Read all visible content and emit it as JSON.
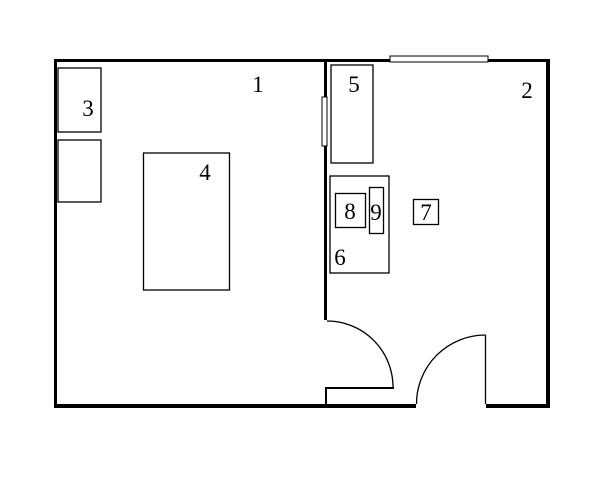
{
  "diagram": {
    "type": "floor-plan",
    "colors": {
      "line": "#000000",
      "background": "#ffffff"
    },
    "rooms": [
      {
        "label": "1"
      },
      {
        "label": "2"
      }
    ],
    "items": [
      {
        "label": "3"
      },
      {
        "label": "4"
      },
      {
        "label": "5"
      },
      {
        "label": "6"
      },
      {
        "label": "7"
      },
      {
        "label": "8"
      },
      {
        "label": "9"
      }
    ]
  }
}
